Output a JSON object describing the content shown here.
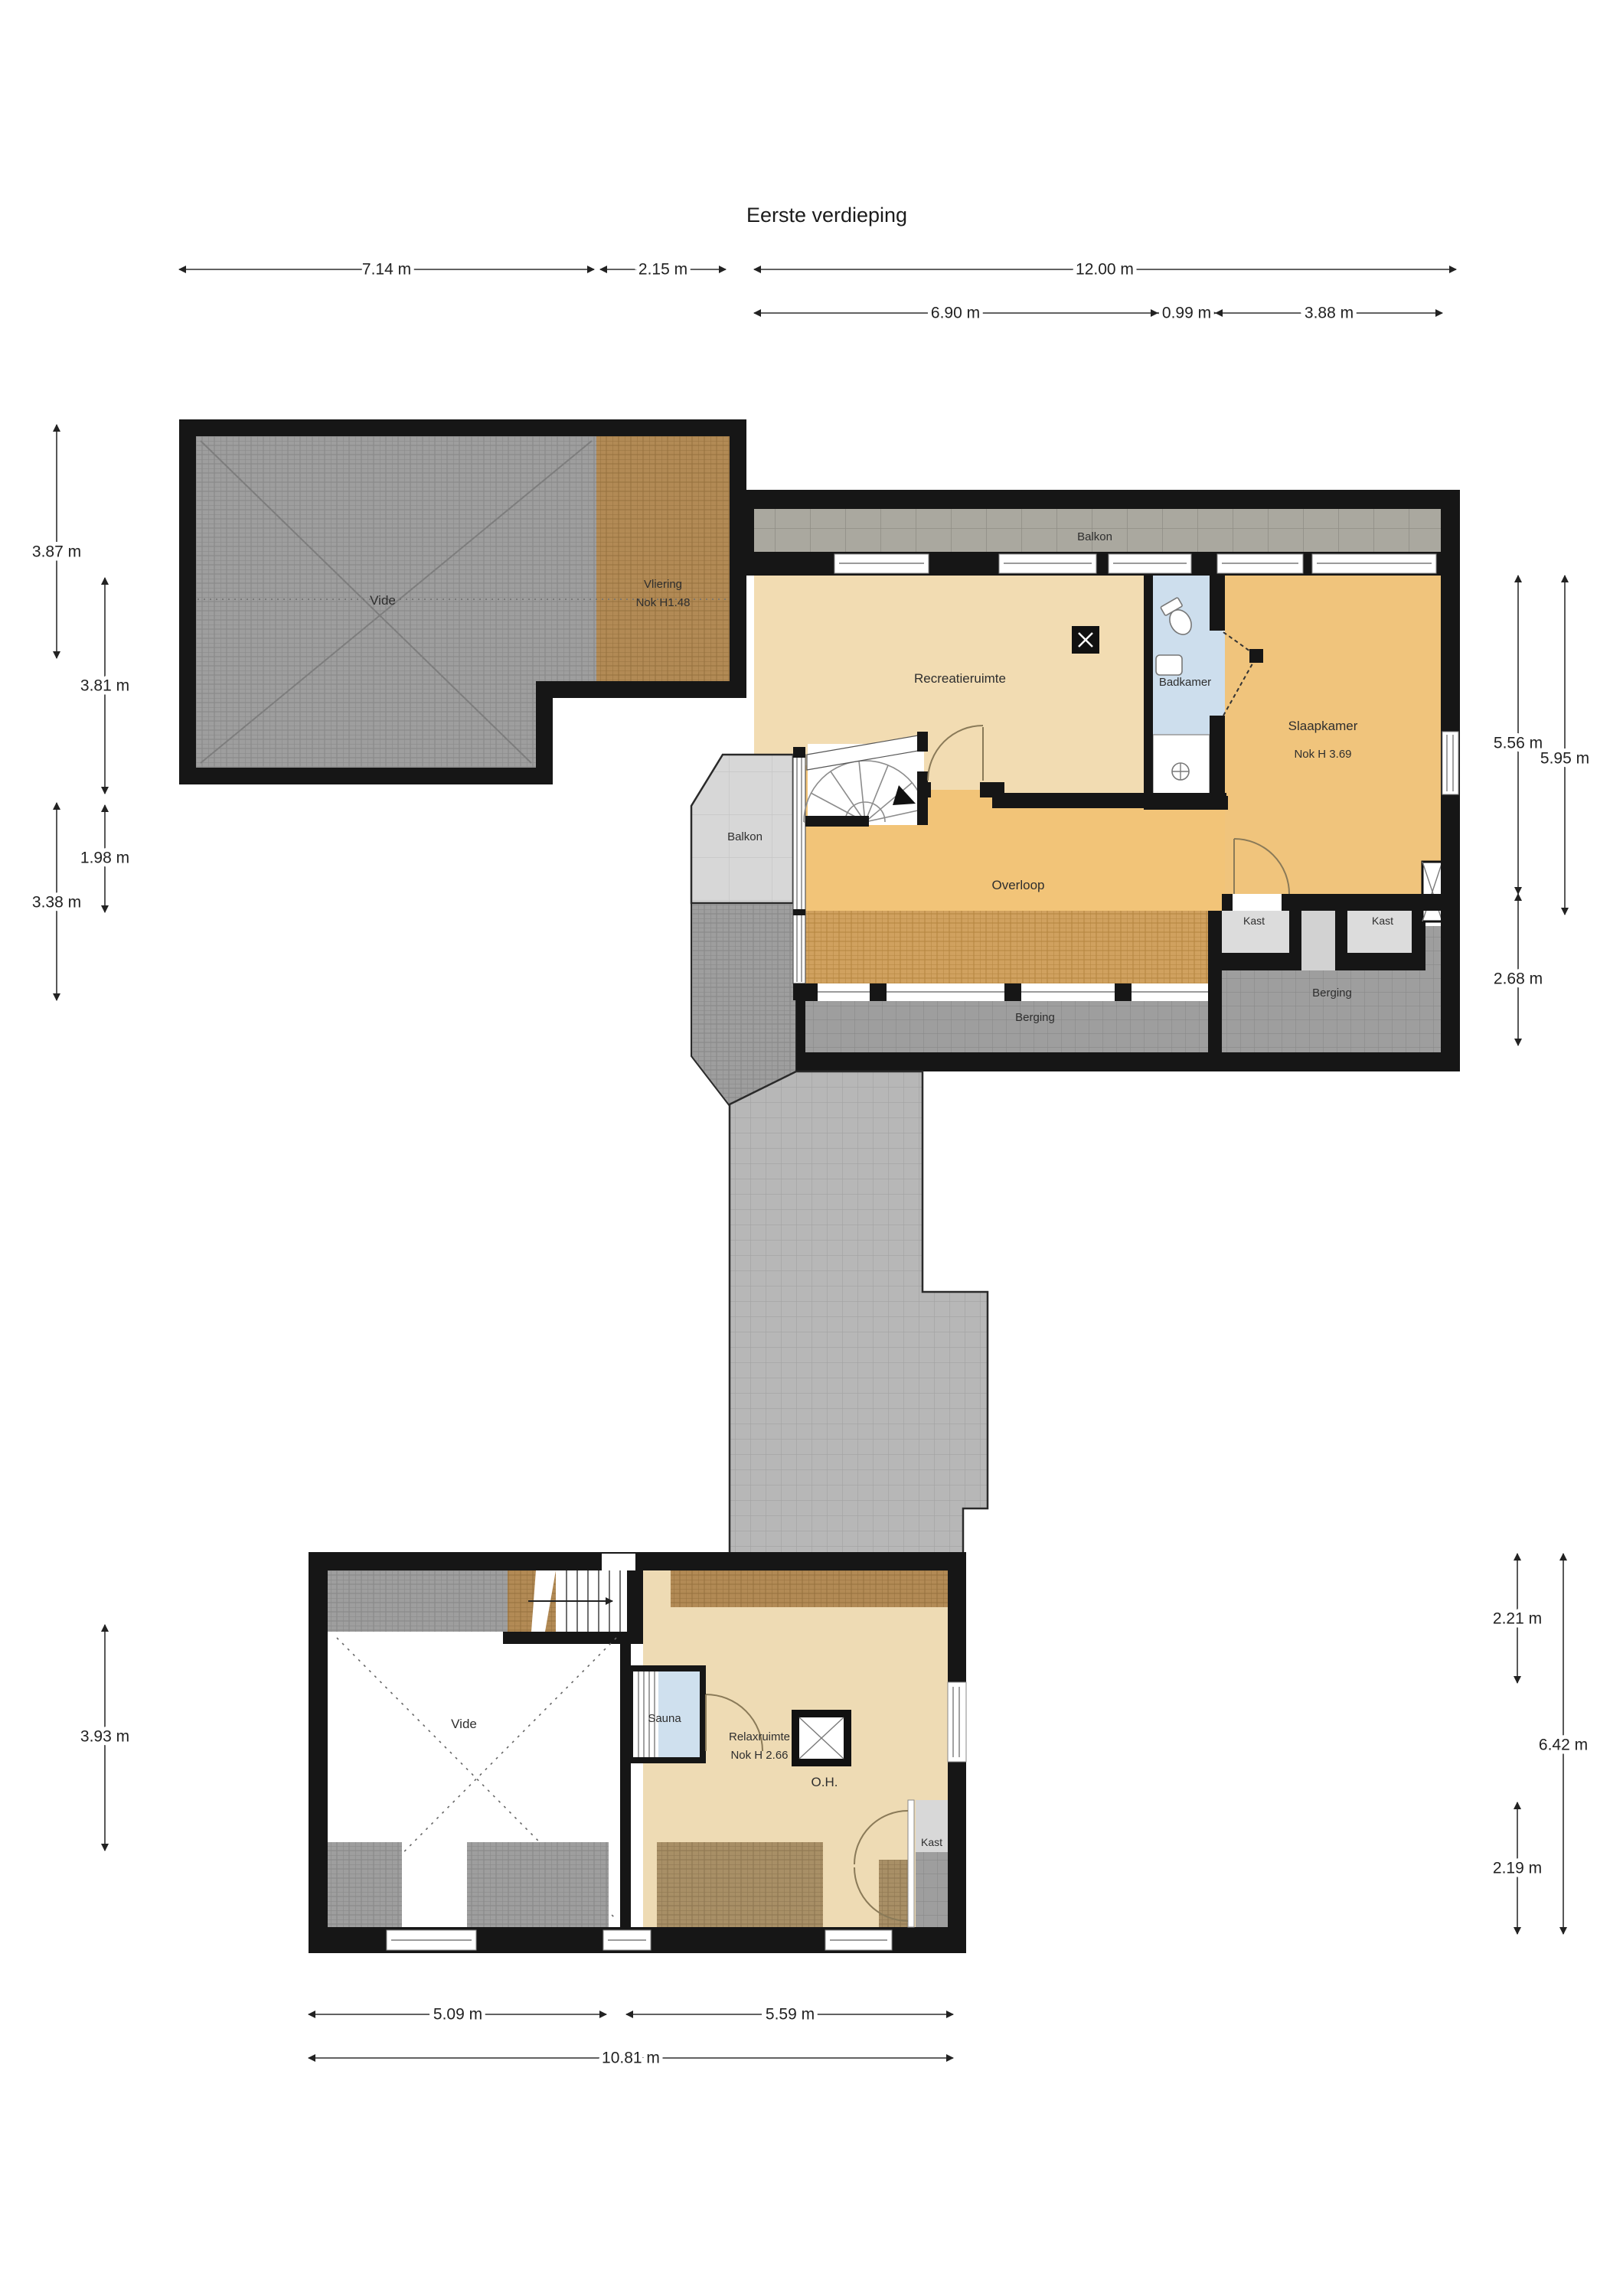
{
  "title": "Eerste verdieping",
  "colors": {
    "wall": "#161616",
    "dimension_line": "#2f2f2f",
    "text": "#2e2e2e",
    "floor_recreatie": "#f2dcb2",
    "floor_badkamer": "#cddeed",
    "floor_slaapkamer": "#f0c47c",
    "floor_overloop": "#f2c478",
    "floor_relax": "#eedbb4",
    "floor_sauna": "#cfe0ee",
    "floor_kast": "#dcdcdc",
    "floor_kast_gap": "#d2d2d2",
    "roof_gray": "#9e9e9e",
    "roof_brown": "#b28a55",
    "roof_tan": "#d0a15f",
    "roof_tan_gray": "#a88f66",
    "paver": "#b7b7b7",
    "paver_dark": "#9e9e9e",
    "paver_big": "#aaa89f",
    "paver_light": "#d7d7d7"
  },
  "rooms": {
    "vide_upper": "Vide",
    "vliering": "Vliering",
    "vliering_nok": "Nok H1.48",
    "balkon_top": "Balkon",
    "recreatieruimte": "Recreatieruimte",
    "badkamer": "Badkamer",
    "slaapkamer": "Slaapkamer",
    "slaapkamer_nok": "Nok H 3.69",
    "balkon_left": "Balkon",
    "overloop": "Overloop",
    "kast_left": "Kast",
    "kast_right": "Kast",
    "berging_right": "Berging",
    "berging_bottom": "Berging",
    "vide_lower": "Vide",
    "sauna": "Sauna",
    "relaxruimte": "Relaxruimte",
    "relaxruimte_nok": "Nok H 2.66",
    "oh": "O.H.",
    "kast_lower": "Kast"
  },
  "dimensions": {
    "top": [
      "7.14 m",
      "2.15 m",
      "12.00 m"
    ],
    "top_sub": [
      "6.90 m",
      "0.99 m",
      "3.88 m"
    ],
    "left_upper": [
      "3.87 m",
      "3.81 m",
      "1.98 m",
      "3.38 m"
    ],
    "right_upper": [
      "5.56 m",
      "5.95 m",
      "2.68 m"
    ],
    "right_lower": [
      "2.21 m",
      "6.42 m",
      "2.19 m"
    ],
    "left_lower": "3.93 m",
    "bottom": [
      "5.09 m",
      "5.59 m",
      "10.81 m"
    ]
  }
}
